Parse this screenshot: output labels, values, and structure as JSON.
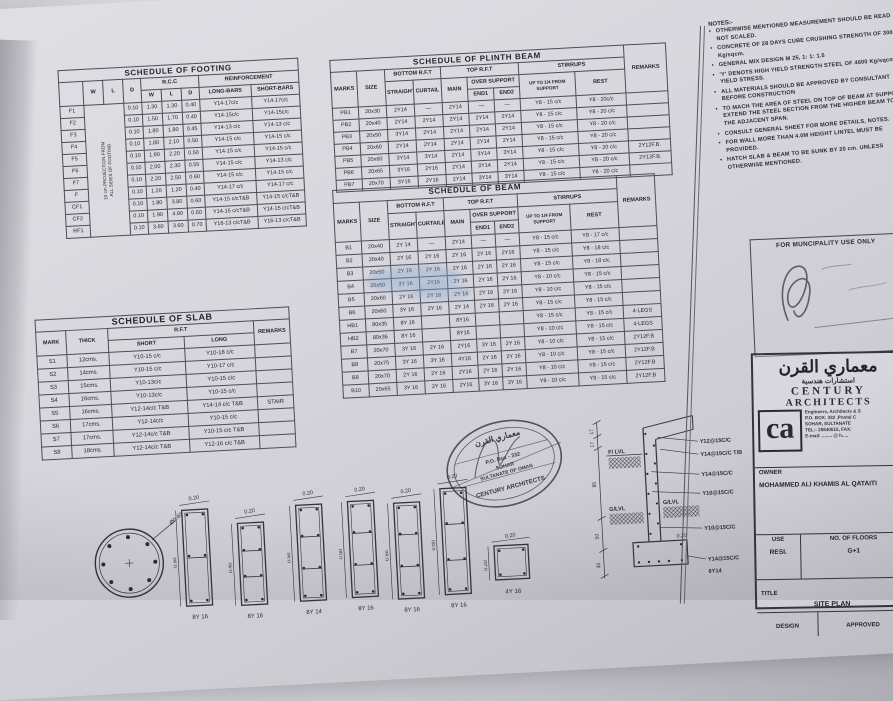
{
  "footing_table": {
    "widths": [
      24,
      20,
      20,
      18,
      20,
      20,
      18,
      52,
      48
    ],
    "header": [
      [
        {
          "t": "SCHEDULE OF FOOTING",
          "cs": 9,
          "cls": "ttl"
        }
      ],
      [
        {
          "t": "",
          "rs": 2
        },
        {
          "t": "W",
          "rs": 2
        },
        {
          "t": "L",
          "rs": 2
        },
        {
          "t": "D",
          "rs": 2
        },
        {
          "t": "R.C.C",
          "cs": 3
        },
        {
          "t": "REINFORCEMENT",
          "cs": 2
        }
      ],
      [
        {
          "t": "W"
        },
        {
          "t": "L"
        },
        {
          "t": "D"
        },
        {
          "t": "LONG-BARS"
        },
        {
          "t": "SHORT-BARS"
        }
      ]
    ],
    "rows": [
      [
        "F1",
        {
          "t": "10 cm PROJECTION FROM\nALL SIDES OF FOOTING",
          "cs": 2,
          "rs": 11,
          "cls": "rot"
        },
        "0.10",
        "1.30",
        "1.30",
        "0.40",
        "Y14-17c/c",
        "Y14-17c/c"
      ],
      [
        "F2",
        "0.10",
        "1.50",
        "1.70",
        "0.40",
        "Y14-15c/c",
        "Y14-15c/c"
      ],
      [
        "F3",
        "0.10",
        "1.80",
        "1.80",
        "0.45",
        "Y14-13 c/c",
        "Y14-13 c/c"
      ],
      [
        "F4",
        "0.10",
        "1.80",
        "2.10",
        "0.50",
        "Y14-15 c/c",
        "Y14-15 c/c"
      ],
      [
        "F5",
        "0.10",
        "1.90",
        "2.20",
        "0.50",
        "Y14-15 c/c",
        "Y14-15 c/c"
      ],
      [
        "F6",
        "0.10",
        "2.00",
        "2.30",
        "0.55",
        "Y14-15 c/c",
        "Y14-13 c/c"
      ],
      [
        "F7",
        "0.10",
        "2.20",
        "2.50",
        "0.60",
        "Y14-15 c/c",
        "Y14-15 c/c"
      ],
      [
        "F",
        "0.10",
        "1.20",
        "1.20",
        "0.40",
        "Y14-17 c/c",
        "Y14-17 c/c"
      ],
      [
        "CF1",
        "0.10",
        "1.80",
        "3.80",
        "0.60",
        "Y14-15 c/cT&B",
        "Y14-15 c/cT&B"
      ],
      [
        "CF2",
        "0.10",
        "1.90",
        "4.90",
        "0.60",
        "Y14-15 c/cT&B",
        "Y14-15 c/cT&B"
      ],
      [
        "RF1",
        "0.10",
        "3.60",
        "3.60",
        "0.70",
        "Y16-13 c/cT&B",
        "Y16-13 c/cT&B"
      ]
    ]
  },
  "plinth_table": {
    "widths": [
      26,
      28,
      28,
      28,
      26,
      26,
      26,
      56,
      50,
      42
    ],
    "header": [
      [
        {
          "t": "SCHEDULE OF PLINTH BEAM",
          "cs": 9,
          "cls": "ttl"
        },
        {
          "t": "REMARKS",
          "rs": 4
        }
      ],
      [
        {
          "t": "MARKS",
          "rs": 3
        },
        {
          "t": "SIZE",
          "rs": 3
        },
        {
          "t": "BOTTOM R.F.T",
          "cs": 2
        },
        {
          "t": "TOP R.F.T",
          "cs": 3
        },
        {
          "t": "STIRRUPS",
          "cs": 2
        }
      ],
      [
        {
          "t": "STRAIGHT",
          "rs": 2
        },
        {
          "t": "CURTAIL",
          "rs": 2
        },
        {
          "t": "MAIN",
          "rs": 2
        },
        {
          "t": "OVER SUPPORT",
          "cs": 2
        },
        {
          "t": "UP TO 1/4 FROM SUPPORT",
          "rs": 2,
          "cls": "wrap"
        },
        {
          "t": "REST",
          "rs": 2
        }
      ],
      [
        {
          "t": "END1"
        },
        {
          "t": "END2"
        }
      ]
    ],
    "rows": [
      [
        "PB1",
        "20x30",
        "2Y14",
        "—",
        "2Y14",
        "—",
        "—",
        "Y8 - 15 c/c",
        "Y8 - 20c/c",
        ""
      ],
      [
        "PB2",
        "20x40",
        "2Y14",
        "2Y14",
        "2Y14",
        "2Y14",
        "2Y14",
        "Y8 - 15 c/c",
        "Y8 - 20 c/c",
        ""
      ],
      [
        "PB3",
        "20x50",
        "3Y14",
        "2Y14",
        "2Y14",
        "2Y14",
        "2Y14",
        "Y8 - 15 c/c",
        "Y8 - 20 c/c",
        ""
      ],
      [
        "PB4",
        "20x60",
        "2Y14",
        "2Y14",
        "2Y14",
        "2Y14",
        "2Y14",
        "Y8 - 15 c/c",
        "Y8 - 20 c/c",
        ""
      ],
      [
        "PB5",
        "20x60",
        "3Y14",
        "3Y14",
        "2Y14",
        "3Y14",
        "3Y14",
        "Y8 - 15 c/c",
        "Y8 - 20 c/c",
        "2Y12F.B."
      ],
      [
        "PB6",
        "20x65",
        "3Y16",
        "2Y16",
        "2Y14",
        "3Y14",
        "2Y14",
        "Y8 - 15 c/c",
        "Y8 - 20 c/c",
        "2Y12F.B."
      ],
      [
        "PB7",
        "20x70",
        "3Y16",
        "2Y16",
        "2Y14",
        "3Y14",
        "3Y14",
        "Y8 - 15 c/c",
        "Y8 - 20 c/c",
        ""
      ]
    ]
  },
  "beam_table": {
    "widths": [
      26,
      28,
      28,
      28,
      26,
      24,
      24,
      52,
      48,
      38
    ],
    "header": [
      [
        {
          "t": "SCHEDULE OF BEAM",
          "cs": 9,
          "cls": "ttl"
        },
        {
          "t": "REMARKS",
          "rs": 4
        }
      ],
      [
        {
          "t": "MARKS",
          "rs": 3
        },
        {
          "t": "SIZE",
          "rs": 3
        },
        {
          "t": "BOTTOM R.F.T",
          "cs": 2
        },
        {
          "t": "TOP R.F.T",
          "cs": 3
        },
        {
          "t": "STIRRUPS",
          "cs": 2
        }
      ],
      [
        {
          "t": "STRAIGHT",
          "rs": 2
        },
        {
          "t": "CURTAILED",
          "rs": 2
        },
        {
          "t": "MAIN",
          "rs": 2
        },
        {
          "t": "OVER SUPPORT",
          "cs": 2
        },
        {
          "t": "UP TO 1/4 FROM SUPPORT",
          "rs": 2,
          "cls": "wrap"
        },
        {
          "t": "REST",
          "rs": 2
        }
      ],
      [
        {
          "t": "END1"
        },
        {
          "t": "END2"
        }
      ]
    ],
    "rows": [
      [
        "B1",
        "20x40",
        "2Y 14",
        "—",
        "2Y14",
        "—",
        "—",
        "Y8 - 15 c/c",
        "Y8 - 17 c/c",
        ""
      ],
      [
        "B2",
        "20x40",
        "2Y 16",
        "2Y 16",
        "2Y 16",
        "2Y 16",
        "2Y16",
        "Y8 - 15 c/c",
        "Y8 - 18 c/c",
        ""
      ],
      [
        "B3",
        "20x50",
        "2Y 16",
        "2Y 16",
        "2Y 16",
        "2Y 16",
        "2Y 16",
        "Y8 - 15 c/c",
        "Y8 - 18 c/c",
        ""
      ],
      [
        "B4",
        "20x50",
        "3Y 16",
        "2Y16",
        "2Y 16",
        "2Y 16",
        "2Y 16",
        "Y8 - 10 c/c",
        "Y8 - 15 c/c",
        ""
      ],
      [
        "B5",
        "20x60",
        "2Y 16",
        "2Y 16",
        "2Y 16",
        "2Y 16",
        "2Y 16",
        "Y8 - 10 c/c",
        "Y8 - 15 c/c",
        ""
      ],
      [
        "B6",
        "20x60",
        "3Y 16",
        "2Y 16",
        "2Y 14",
        "2Y 16",
        "2Y 16",
        "Y8 - 15 c/c",
        "Y8 - 15 c/c",
        ""
      ],
      [
        "HB1",
        "80x35",
        "8Y 16",
        "",
        "8Y16",
        "",
        "",
        "Y8 - 15 c/c",
        "Y8 - 15 c/c",
        "4-LEGS"
      ],
      [
        "HB2",
        "80x36",
        "8Y 16",
        "",
        "8Y16",
        "",
        "",
        "Y8 - 10 c/c",
        "Y8 - 15 c/c",
        "4-LEGS"
      ],
      [
        "B7",
        "20x70",
        "3Y 16",
        "2Y 16",
        "2Y16",
        "3Y 16",
        "2Y 16",
        "Y8 - 10 c/c",
        "Y8 - 15 c/c",
        "2Y12F.B"
      ],
      [
        "B8",
        "20x75",
        "3Y 16",
        "3Y 16",
        "4Y16",
        "2Y 16",
        "2Y 16",
        "Y8 - 10 c/c",
        "Y8 - 15 c/c",
        "2Y12F.B"
      ],
      [
        "B9",
        "20x70",
        "2Y 16",
        "2Y 16",
        "2Y16",
        "2Y 16",
        "2Y 16",
        "Y8 - 10 c/c",
        "Y8 - 15 c/c",
        "2Y12F.B"
      ],
      [
        "B10",
        "20x65",
        "3Y 16",
        "2Y 16",
        "2Y16",
        "3Y 16",
        "3Y 16",
        "Y8 - 10 c/c",
        "Y8 - 15 c/c",
        "2Y12F.B"
      ]
    ]
  },
  "slab_table": {
    "widths": [
      30,
      42,
      76,
      70,
      36
    ],
    "header": [
      [
        {
          "t": "SCHEDULE OF SLAB",
          "cs": 5,
          "cls": "ttl"
        }
      ],
      [
        {
          "t": "MARK",
          "rs": 2
        },
        {
          "t": "THICK",
          "rs": 2
        },
        {
          "t": "R.F.T",
          "cs": 2
        },
        {
          "t": "REMARKS",
          "rs": 2
        }
      ],
      [
        {
          "t": "SHORT"
        },
        {
          "t": "LONG"
        }
      ]
    ],
    "rows": [
      [
        "S1",
        "12cms.",
        "Y10-15 c/c",
        "Y10-18 c/c",
        ""
      ],
      [
        "S2",
        "14cms.",
        "Y10-15 c/c",
        "Y10-17 c/c",
        ""
      ],
      [
        "S3",
        "15cms.",
        "Y10-13c/c",
        "Y10-15 c/c",
        ""
      ],
      [
        "S4",
        "16cms.",
        "Y10-13c/c",
        "Y10-15 c/c",
        ""
      ],
      [
        "S5",
        "16cms.",
        "Y12-14c/c T&B",
        "Y14-14 c/c T&B",
        "STAIR"
      ],
      [
        "S6",
        "17cms.",
        "Y12-14c/c",
        "Y10-15 c/c",
        ""
      ],
      [
        "S7",
        "17cms.",
        "Y12-14c/c T&B",
        "Y10-15 c/c T&B",
        ""
      ],
      [
        "S8",
        "18cms.",
        "Y12-14c/c T&B",
        "Y12-16 c/c T&B",
        ""
      ]
    ]
  },
  "notes": {
    "heading": "NOTES:-",
    "items": [
      "OTHERWISE MENTIONED MEASUREMENT SHOULD BE READ NOT SCALED.",
      "CONCRETE OF 28 DAYS CUBE CRUSHING STRENGTH OF 300 Kg/sqcm.",
      "GENERAL MIX DESIGN  M 25, 1: 1: 1.5",
      "'Y' DENOTS HIGH YIELD STRENGTH STEEL OF 4600 Kg/sqcm YIELD STRESS.",
      "ALL MATERIALS SHOULD BE APPROVED BY CONSULTANT BEFORE CONSTRUCTION",
      "TO MACH THE AREA  OF STEEL ON TOP OF BEAM AT SUPPORT EXTEND THE STEEL SECTION FROM THE HIGHER  BEAM TO THE ADJACENT SPAN.",
      "CONSULT GENERAL SHEET FOR MORE DETAILS, NOTES.",
      "FOR WALL MORE THAN 4.0M HEIGHT LINTEL MUST BE  PROVIDED.",
      "HATCH SLAB & BEAM TO BE SUNK BY 20 cm. UNLESS OTHERWISE MENTIONED."
    ]
  },
  "municipality": {
    "label": "FOR MUNCIPALITY USE ONLY"
  },
  "title_block": {
    "arabic_title": "معماري القرن",
    "arabic_sub": "استشارات هندسية",
    "name_line1": "CENTURY",
    "name_line2": "ARCHITECTS",
    "logo": "ca",
    "address": [
      "Engineers, Architects & S",
      "P.O. BOX: 332 ,Postal C",
      "SOHAR, SULTANATE",
      "TEL:- 26840515, FAX:",
      "E-mail: ........ @ h....."
    ],
    "owner_label": "OWNER",
    "owner_name": "MOHAMMED ALI KHAMIS AL QATAITI",
    "use_label": "USE",
    "use_value": "RESI.",
    "floors_label": "NO. OF FLOORS",
    "floors_value": "G+1",
    "title_label": "TITLE",
    "title_value": "SITE PLAN",
    "design_label": "DESIGN",
    "approved_label": "APPROVED"
  },
  "stamp": {
    "arabic": "معماري القرن",
    "line1": "P.O. Box - 332",
    "line2": "SOHAR",
    "line3": "SULTANATE OF OMAN",
    "bottom": "CENTURY ARCHITECTS"
  },
  "sections": [
    {
      "type": "circle",
      "dia": "Ø0.40",
      "bars": "8Y 16"
    },
    {
      "type": "rect",
      "w": "0.20",
      "h": "0.50",
      "bars": "8Y 16"
    },
    {
      "type": "rect",
      "w": "0.20",
      "h": "0.40",
      "bars": "8Y 16"
    },
    {
      "type": "rect",
      "w": "0.20",
      "h": "0.50",
      "bars": "8Y 14"
    },
    {
      "type": "rect",
      "w": "0.20",
      "h": "0.50",
      "bars": "8Y 16"
    },
    {
      "type": "rect",
      "w": "0.20",
      "h": "0.50",
      "bars": "8Y 16"
    },
    {
      "type": "rect",
      "w": "0.20",
      "h": "0.60",
      "bars": "8Y 16"
    },
    {
      "type": "square",
      "w": "0.20",
      "h": "0.20",
      "bars": "4Y 16"
    }
  ],
  "detail": {
    "flvl": "F/ LVL",
    "glvl_left": "G/LVL",
    "glvl_right": "G/LVL",
    "labels": [
      "Y12@15C/C",
      "Y14@15C/C T/B",
      "Y14@15C/C",
      "Y10@15C/C",
      "Y10@15C/C",
      "0.20",
      "Y14@15C/C",
      "6Y14"
    ],
    "dims": [
      "17",
      "17",
      "85",
      "50",
      "30"
    ]
  },
  "colors": {
    "paper": "#d8d7dd",
    "ink": "#26252e",
    "watermark_blue": "#8fb0d6"
  }
}
